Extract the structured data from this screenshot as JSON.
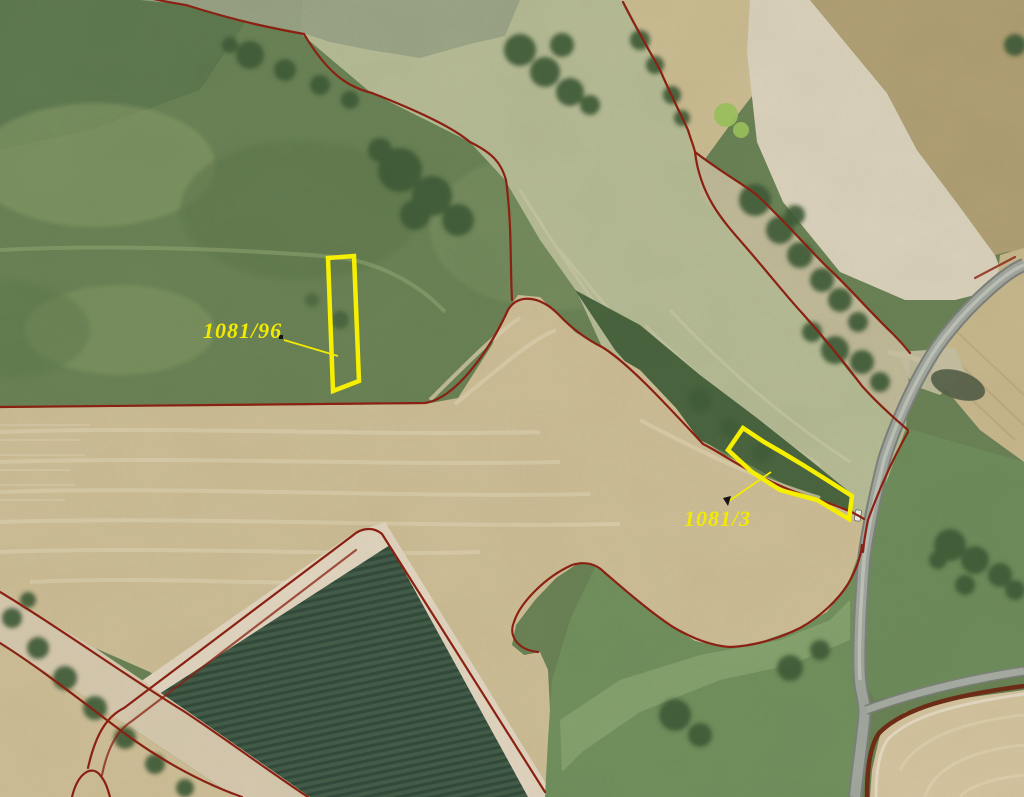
{
  "map": {
    "kind": "aerial cadastral orthophoto",
    "parcels": [
      {
        "id": "1081/96"
      },
      {
        "id": "1081/3"
      }
    ],
    "colors": {
      "parcel_outline": "#f6ef00",
      "label_text": "#f2ea00",
      "leader_line": "#f2ea00",
      "cadastral_line": "#8e2112",
      "cadastral_line_dark": "#6f2c16",
      "road": "#a3a8a0"
    }
  }
}
